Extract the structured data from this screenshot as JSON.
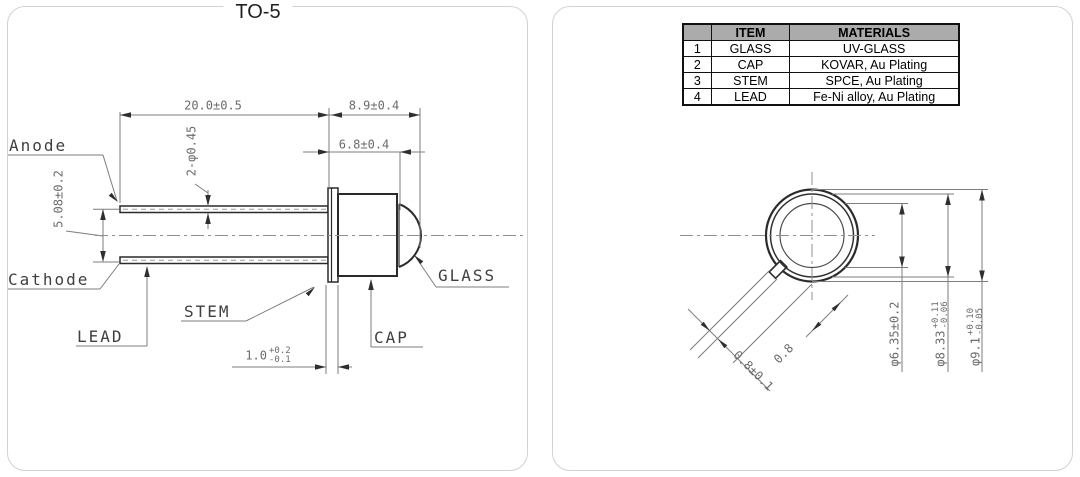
{
  "title": "TO-5",
  "side_view": {
    "labels": {
      "anode": "Anode",
      "cathode": "Cathode",
      "lead": "LEAD",
      "stem": "STEM",
      "cap": "CAP",
      "glass": "GLASS"
    },
    "dims": {
      "lead_length": "20.0±0.5",
      "total_head_length": "8.9±0.4",
      "cap_length": "6.8±0.4",
      "lead_diameter": "2-φ0.45",
      "lead_pitch": "5.08±0.2",
      "stem_thickness": "1.0",
      "stem_thickness_plus": "+0.2",
      "stem_thickness_minus": "-0.1"
    }
  },
  "top_view": {
    "dims": {
      "window_diameter": "φ6.35±0.2",
      "cap_diameter": "φ8.33",
      "cap_diameter_plus": "+0.11",
      "cap_diameter_minus": "-0.06",
      "flange_diameter": "φ9.1",
      "flange_diameter_plus": "+0.10",
      "flange_diameter_minus": "-0.05",
      "tab_width": "0.8",
      "tab_width_tol": "0.8±0.1"
    }
  },
  "materials_table": {
    "headers": {
      "no": "",
      "item": "ITEM",
      "material": "MATERIALS"
    },
    "rows": [
      {
        "no": "1",
        "item": "GLASS",
        "material": "UV-GLASS"
      },
      {
        "no": "2",
        "item": "CAP",
        "material": "KOVAR, Au Plating"
      },
      {
        "no": "3",
        "item": "STEM",
        "material": "SPCE, Au Plating"
      },
      {
        "no": "4",
        "item": "LEAD",
        "material": "Fe-Ni alloy, Au Plating"
      }
    ]
  },
  "colors": {
    "outline": "#2a2a2a",
    "dimension_lines": "#7d7d7d",
    "table_header_bg": "#ababab",
    "panel_border": "#d2d2d2"
  }
}
